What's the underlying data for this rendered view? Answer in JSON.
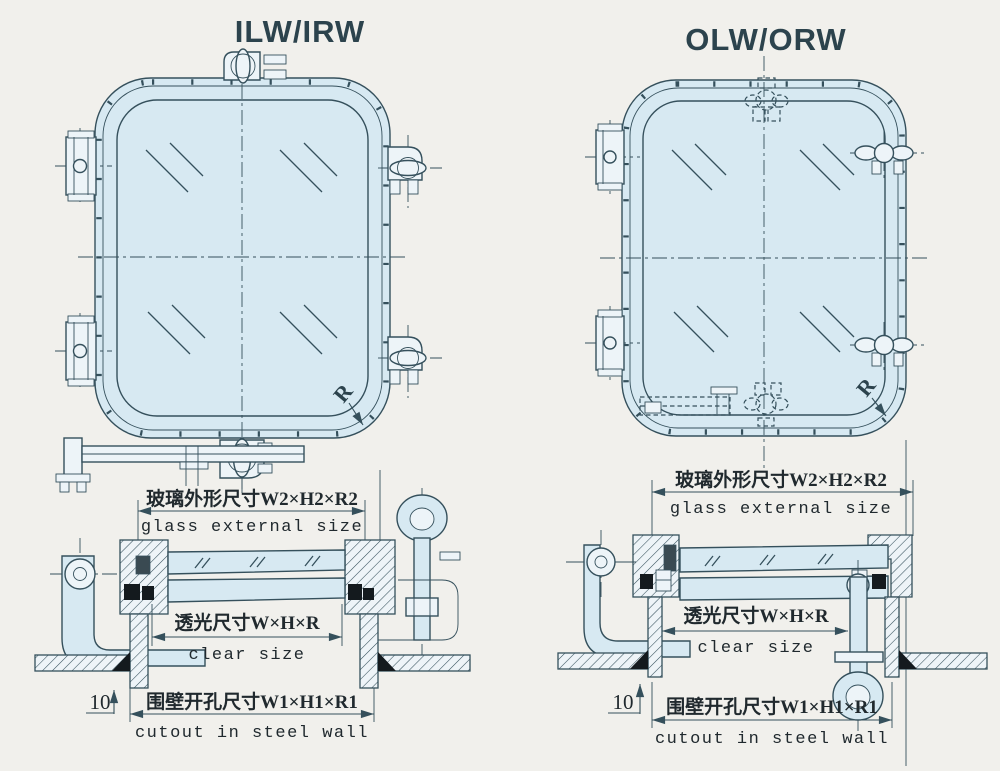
{
  "colors": {
    "line": "#35505c",
    "glass_fill": "#d7e9f2",
    "paper": "#f1f0ec",
    "gasket": "#141a1e"
  },
  "left_assembly": {
    "title": "ILW/IRW",
    "front_view": {
      "corner_radius_label": "R"
    },
    "section_view": {
      "glass_external_cn": "玻璃外形尺寸W2×H2×R2",
      "glass_external_en": "glass external size",
      "clear_cn": "透光尺寸W×H×R",
      "clear_en": "clear size",
      "cutout_cn": "围壁开孔尺寸W1×H1×R1",
      "cutout_en": "cutout in steel wall",
      "wall_offset_label": "10"
    }
  },
  "right_assembly": {
    "title": "OLW/ORW",
    "front_view": {
      "corner_radius_label": "R"
    },
    "section_view": {
      "glass_external_cn": "玻璃外形尺寸W2×H2×R2",
      "glass_external_en": "glass external size",
      "clear_cn": "透光尺寸W×H×R",
      "clear_en": "clear size",
      "cutout_cn": "围壁开孔尺寸W1×H1×R1",
      "cutout_en": "cutout in steel wall",
      "wall_offset_label": "10"
    }
  }
}
